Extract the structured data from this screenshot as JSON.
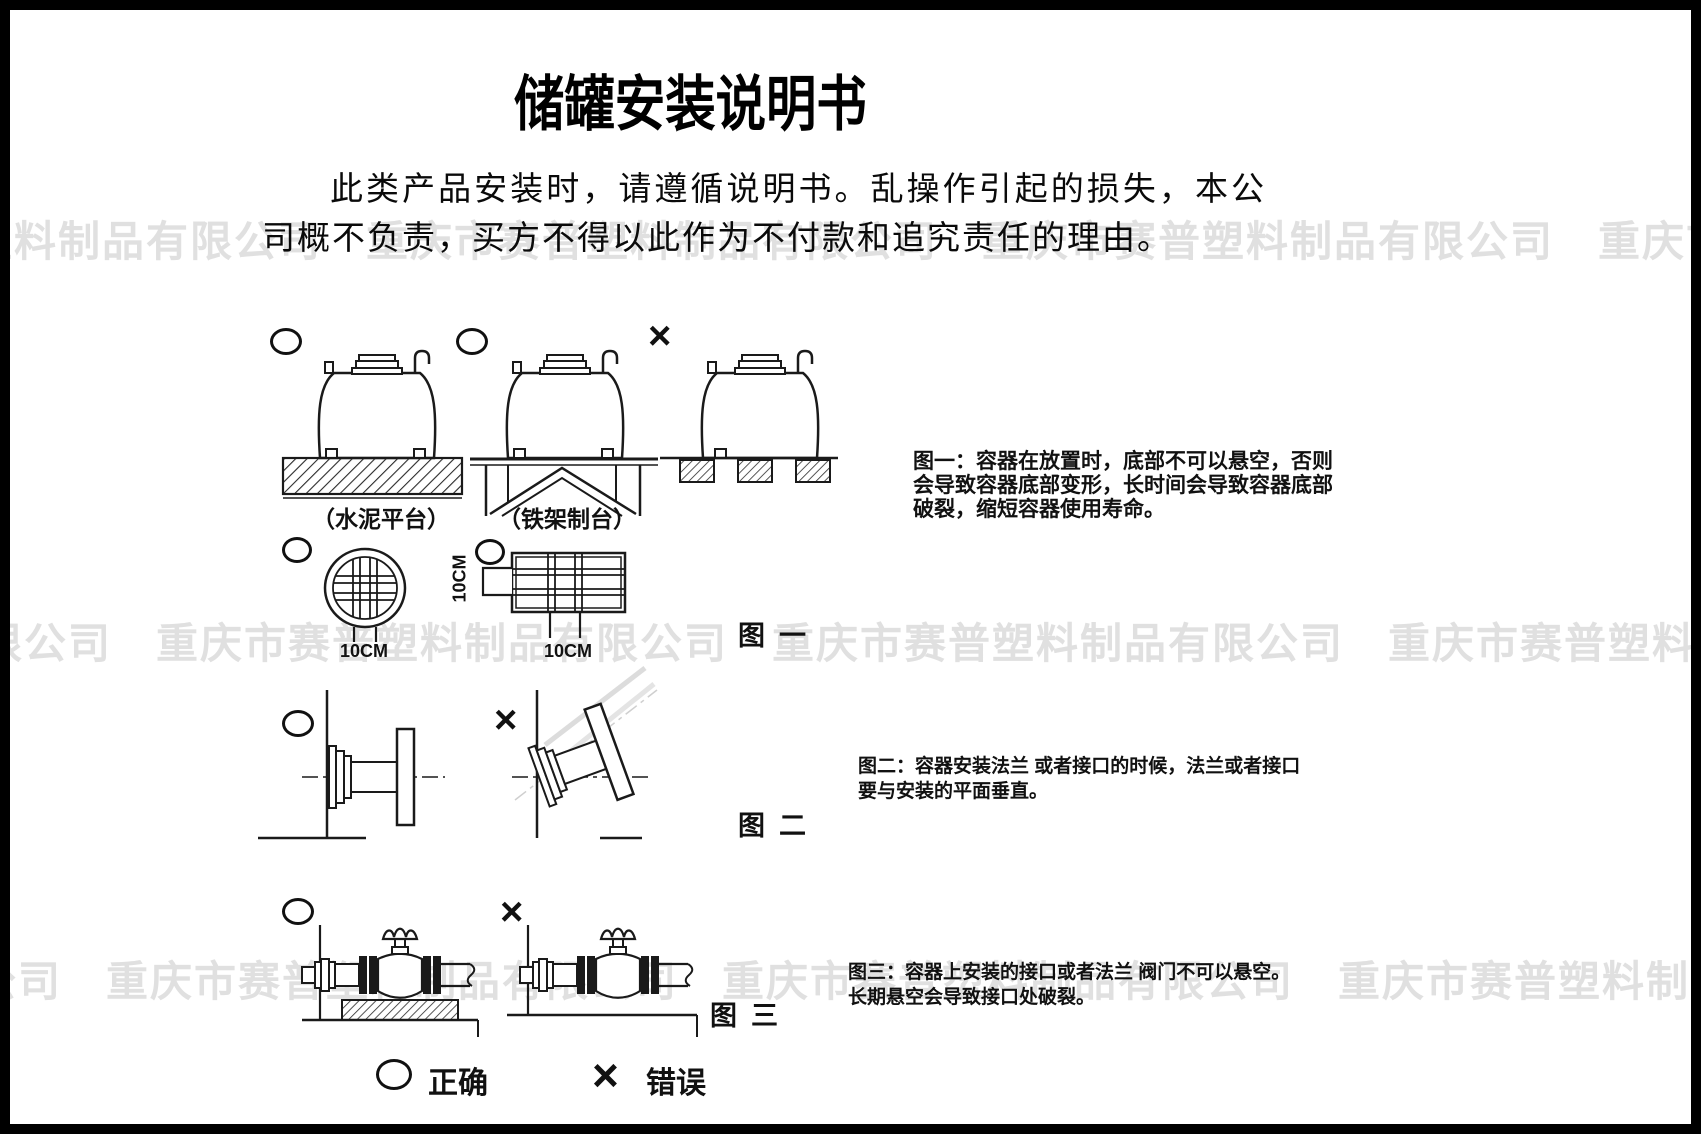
{
  "header": {
    "title": "储罐安装说明书"
  },
  "intro": {
    "text": "此类产品安装时，请遵循说明书。乱操作引起的损失，本公司概不负责，买方不得以此作为不付款和追究责任的理由。"
  },
  "watermark": {
    "company": "重庆市赛普塑料制品有限公司",
    "band_text": "重庆市赛普塑料制品有限公司　重庆市赛普塑料制品有限公司　重庆市赛普塑料制品有限公司　重庆市赛普塑料制品有限公司　重庆市赛普塑料制品有限公司"
  },
  "figure1": {
    "label": "图一",
    "platform_concrete": "（水泥平台）",
    "platform_frame": "（铁架制台）",
    "dim_round_bottom": "10CM",
    "dim_rect_side": "10CM",
    "dim_rect_bottom": "10CM",
    "caption_lines": [
      "图一：容器在放置时，底部不可以悬空，否则",
      "会导致容器底部变形，长时间会导致容器底部",
      "破裂，缩短容器使用寿命。"
    ]
  },
  "figure2": {
    "label": "图二",
    "caption_lines": [
      "图二：容器安装法兰 或者接口的时候，法兰或者接口",
      "要与安装的平面垂直。"
    ]
  },
  "figure3": {
    "label": "图三",
    "caption_lines": [
      "图三：容器上安装的接口或者法兰 阀门不可以悬空。",
      "长期悬空会导致接口处破裂。"
    ]
  },
  "legend": {
    "correct": "正确",
    "wrong": "错误"
  },
  "icons": {
    "correct_glyph": "○",
    "wrong_glyph": "×"
  }
}
